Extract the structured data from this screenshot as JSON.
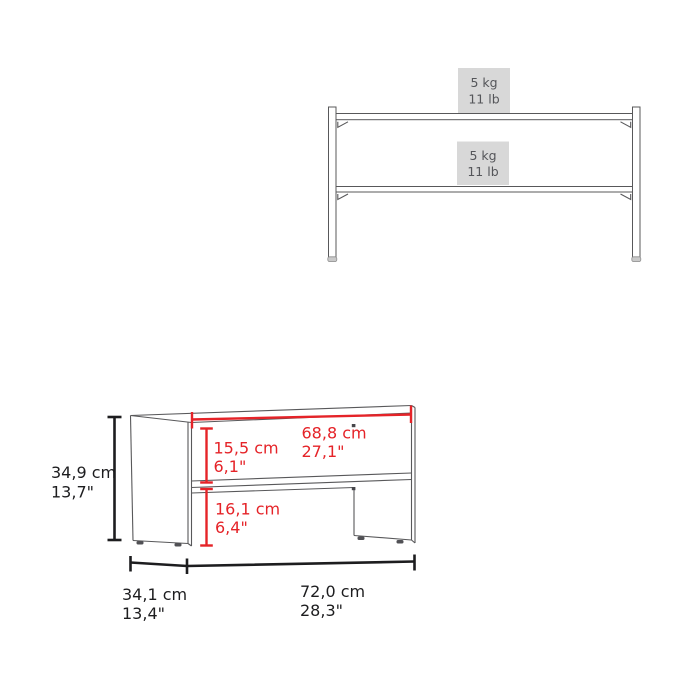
{
  "colors": {
    "background": "#ffffff",
    "furniture_outline": "#58585a",
    "dimension_line_black": "#1d1d1f",
    "dimension_line_red": "#e52328",
    "capacity_box_fill": "#d8d8d8",
    "capacity_text": "#55565a"
  },
  "front_view": {
    "top_shelf_capacity": {
      "kg": "5 kg",
      "lb": "11 lb"
    },
    "lower_shelf_capacity": {
      "kg": "5 kg",
      "lb": "11 lb"
    }
  },
  "dimension_view": {
    "overall_height": {
      "cm": "34,9 cm",
      "inch": "13,7\""
    },
    "upper_shelf_clearance": {
      "cm": "15,5 cm",
      "inch": "6,1\""
    },
    "inner_width": {
      "cm": "68,8 cm",
      "inch": "27,1\""
    },
    "lower_shelf_clearance": {
      "cm": "16,1 cm",
      "inch": "6,4\""
    },
    "overall_depth": {
      "cm": "34,1 cm",
      "inch": "13,4\""
    },
    "overall_width": {
      "cm": "72,0 cm",
      "inch": "28,3\""
    }
  }
}
